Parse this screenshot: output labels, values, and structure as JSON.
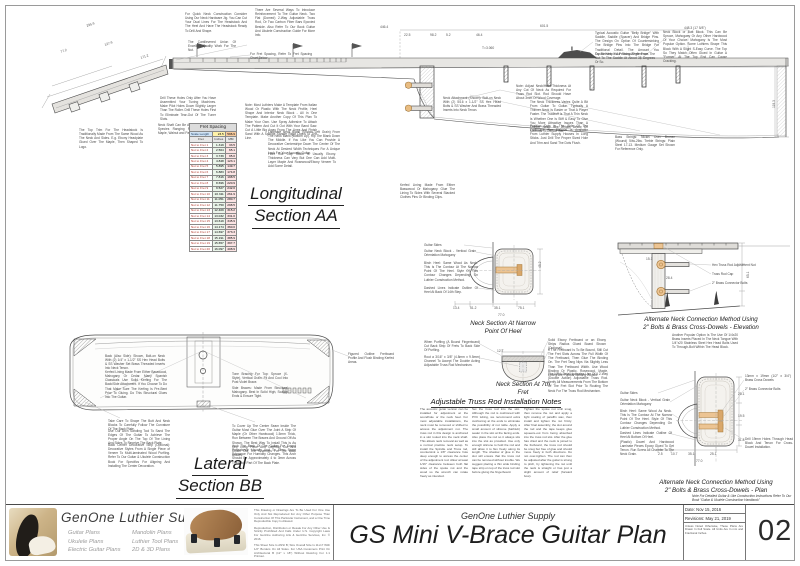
{
  "sheet": {
    "company_small": "GenOne Luthier Supply",
    "title": "GS Mini V-Brace Guitar Plan",
    "number": "02",
    "date": "Date: Nov 15, 2016",
    "revision": "Revisions: May 21, 2019",
    "scale_note": "Unless Noted Otherwise, These Plans Are Drawn In Full Scale. All Units Are In mm and Fractional Inches."
  },
  "logo": {
    "brand": "GenOne Luthier Supplies",
    "plan_types_col1": [
      "Guitar Plans",
      "Ukulele Plans",
      "Electric Guitar Plans"
    ],
    "plan_types_col2": [
      "Mandolin Plans",
      "Luthier Tool Plans",
      "2D & 3D Plans"
    ],
    "legal": [
      "This Drawing or Drawings Are To Be Used For One Use Only And Not Reproduced For Any Other Purpose Than Construction Of This Particular Instrument, and a One Time Reproducible Copy Is Allowed.",
      "Reproduction, Distribution or Resale For Any Other Use Is Strictly Prohibited And Falls Under U.S. Copyright Laws For GenOne Authoring Arts & GenOne Services, Inc. © 2016.",
      "This Sheet Size Is ANSI B; Size Overall Size Is 11x17 With 1/2\" Borders On All Sides. For USA Customers Print On Architectural B (12\" x 18\") Without Resizing For 1:1 Printout."
    ]
  },
  "section_labels": {
    "longitudinal1": "Longitudinal",
    "longitudinal2": "Section AA",
    "lateral1": "Lateral",
    "lateral2": "Section BB",
    "neck_narrow1": "Neck Section At Narrow",
    "neck_narrow2": "Point Of Heel",
    "neck_7th1": "Neck Section At 7th",
    "neck_7th2": "Fret",
    "alt_elev1": "Alternate Neck Connection Method Using",
    "alt_elev2": "2\" Bolts & Brass Cross-Dowels - Elevation",
    "alt_plan1": "Alternate Neck Connection Method Using",
    "alt_plan2": "2\" Bolts & Brass Cross-Dowels - Plan",
    "handbook": "Note For Detailed Guitar & Uke Construction Instructions Refer To Our Book \"Guitar & Ukulele Construction Handbook\""
  },
  "truss_notes": {
    "title": "Adjustable Truss Rod Installation Notes",
    "columns": [
      "The acoustic guitar version can be installed for adjustment at the soundhole or the neck heel. For most adjustable installations, the neck must be removed or shifted to access the adjustment nut. The truss rod in this design is anchored in a slot routed into the neck shaft. This allows neck removal as well as a normal practice neck setup. To install the Spindle and Truss rod, countersink a 1/8\" clearance hole deep enough to access the center of the adjustment rod. Allow at least 1/16\" clearance between both flat sides of the spoke nut and the wood so the wrench can rotate freely as intended.",
      "Set the truss rod into the slot. Although the rod is cushioned with PVC tubing, we recommend extra cushioning at the ends to eliminate the possibility of nut rattle. Apply a small amount of silicone (bathtub) sealer in the slot at the facing ends. Also place the rod so it always sits into the slot as provided. Use only enough silicone to hold the rod and still allow it to flex freely along its length. The shadow of glue in the slot will ensure that the truss rod can be removed without trouble. We suggest placing a thin wide binding tape strip on top of the truss rod slot before gluing the fingerboard.",
      "Tighten the spoke nut until snug, then remove the nut and apply a light coating of paraffin wax, then install and tighten the nut firmly. After final assembly, the slot around the rod and the tape keeps glue squeeze-out from being absorbed into the truss rod slot. After the glue has dried and the neck is joined to the fretboard, the truss rod should be snug but free of glue and should move freely in both directions. Do not over-tighten. The rod can then be adjusted after the guitar is strung to pitch, by tightening the nut until the neck is straight or has just a slight amount of relief (forward bow)."
    ]
  },
  "fret_table": {
    "title": "Fret Spacing",
    "scale_label": "Scale Length",
    "scale_in": "23.5",
    "scale_mm": "596.9",
    "col_fret": "Fret",
    "col_in": "Inches",
    "col_mm": "MM",
    "rows": [
      [
        "Nut to Fret 1",
        "1.319",
        "33.5"
      ],
      [
        "Nut to Fret 2",
        "2.564",
        "65.1"
      ],
      [
        "Nut to Fret 3",
        "3.739",
        "95.0"
      ],
      [
        "Nut to Fret 4",
        "4.848",
        "123.1"
      ],
      [
        "Nut to Fret 5",
        "5.895",
        "149.7"
      ],
      [
        "Nut to Fret 6",
        "6.883",
        "174.8"
      ],
      [
        "Nut to Fret 7",
        "7.816",
        "198.5"
      ],
      [
        "Nut to Fret 8",
        "8.696",
        "220.9"
      ],
      [
        "Nut to Fret 9",
        "9.527",
        "242.0"
      ],
      [
        "Nut to Fret 10",
        "10.311",
        "261.9"
      ],
      [
        "Nut to Fret 11",
        "11.051",
        "280.7"
      ],
      [
        "Nut to Fret 12",
        "11.750",
        "298.5"
      ],
      [
        "Nut to Fret 13",
        "12.409",
        "315.2"
      ],
      [
        "Nut to Fret 14",
        "13.032",
        "331.0"
      ],
      [
        "Nut to Fret 15",
        "13.619",
        "345.9"
      ],
      [
        "Nut to Fret 16",
        "14.174",
        "360.0"
      ],
      [
        "Nut to Fret 17",
        "14.697",
        "373.3"
      ],
      [
        "Nut to Fret 18",
        "15.191",
        "385.9"
      ],
      [
        "Nut to Fret 19",
        "15.657",
        "397.7"
      ],
      [
        "Nut to Fret 20",
        "16.097",
        "408.9"
      ]
    ]
  },
  "annotations": {
    "notes": [
      {
        "x": 185,
        "y": 12,
        "w": 62,
        "t": "For Quick Neck Construction Consider Using Our Neck Hardware Jig. You Can Cut Your Dual Lines For The Headstock And The Heel And Have The Headstock Ready To Drill And Shape."
      },
      {
        "x": 255,
        "y": 8,
        "w": 60,
        "t": "There Are Several Ways To Introduce Reinforcement To The Guitar Neck. Two Flat (Domed) 2-Way Adjustable Truss Rod, Or Two Carbon Fiber Bars Epoxied Beside. Also Refer To Our Book Guitar And Ukulele Construction Guide For More Info."
      },
      {
        "x": 188,
        "y": 40,
        "w": 48,
        "t": "The Cantilevered Union Of Excellent Quality Work For The Nut."
      },
      {
        "x": 250,
        "y": 52,
        "w": 62,
        "t": "For Fret Spacing, Refer To Fret Spacing Chart Below"
      },
      {
        "x": 516,
        "y": 84,
        "w": 55,
        "t": "Note: Adjust Neck/Heel Thickness At Any Cut Of Neck As Required For Truss Rod Slot. Rod Should Have About 3mm Of Wood Coverage."
      },
      {
        "x": 160,
        "y": 96,
        "w": 56,
        "t": "Drill These Holes Only After You Have Assembled Your Tuning Machines. Make Pilot Holes Down Slightly Larger Than The Roller. Drill These Holes First To Eliminate Tear-Out Of The Tuner Slots."
      },
      {
        "x": 158,
        "y": 123,
        "w": 56,
        "t": "Neck Shaft Can Be A Variety Of Wood Species Ranging From Mahogany, Maple, Walnut and Padauk."
      },
      {
        "x": 79,
        "y": 128,
        "w": 64,
        "t": "The Top Trim For The Headstock Is Traditionally Made From The Same Wood As The Neck And Sides. E.g. Ebony Headplate Glued Over The Maple, Then Shaped To Logo."
      },
      {
        "x": 245,
        "y": 103,
        "w": 72,
        "t": "Note: Most Luthiers Make A Template From Italian Wood Or Plastic With The Neck Profile, Heel Shape And Interior Neck Block - All In One Template. Make Another Copy Of This Plan To Make Your Own. Use Spray Adhesive To Attach The Pattern And Cut It Out With Your Band Saw. Cut A Little Big Away From The Lines And Finish Sand With A Spindle Sander Right Down To The Line."
      },
      {
        "x": 268,
        "y": 130,
        "w": 72,
        "t": "Laminate Neck Blank (Shown Left Grain) From The Neck Blank (Bottom Up). Rip The Blank Down The Middle. If You Like You Can Provide A Decorative Centerstripe Down The Center Of The Neck At Desired Width Techniques For A Unique Look For Your Acoustic Guitar."
      },
      {
        "x": 268,
        "y": 152,
        "w": 68,
        "t": "Fibre Dot Cap Stock Is Usually Ebony. Thickness Can Vary But One Can Add Multi-Layer Maple And Rosewood/Ebony Veneer To Add Some Detail."
      },
      {
        "x": 443,
        "y": 96,
        "w": 58,
        "t": "Neck Attachment (Shown): Bolt-on Neck With (2) 5/16 x 1-1/2\" SS Hex Head Bolts & SS Washer And Brass Threaded Inserts Into Neck Tenon."
      },
      {
        "x": 595,
        "y": 31,
        "w": 64,
        "t": "Typical Acoustic Guitar \"Belly Bridge\" With Saddle, Saddle (Spacer) And Bridge Pins. The Design On Option Of Countersinking The Bridge Pins Into The Bridge For Traditional Detail. The Amount You Countersink Is A Personal Preference."
      },
      {
        "x": 595,
        "y": 52,
        "w": 60,
        "t": "Try To Keep Your String Angle From The Nut To The Saddle At About 35 Degrees Or So."
      },
      {
        "x": 663,
        "y": 30,
        "w": 64,
        "t": "Neck Block or Butt Block. This Can Be Spruce, Mahogany Or Any Other Hardwood Of Your Choice. Mahogany Is The Most Popular Option. Some Luthiers Shape This Block With A Slight S-Easy Curve. The Top So They Match Often Glued In Guitar A \"Former\" At The Top End Can Cause Cracking."
      },
      {
        "x": 530,
        "y": 100,
        "w": 58,
        "t": "The Neck Thickness Varies Quite A Bit From Guitar To Guitar. Typically A Thinner Neck Is Easier or That A Player Faster. The Tradeoff Is That A Thin Neck Is Whether One Is Stiff & Easy To Give You More Attractive Issues Than A Thicker Neck. See Details Below On Methods To Decide Too."
      },
      {
        "x": 530,
        "y": 124,
        "w": 58,
        "t": "Position Dots In The Side Of The Fretboard. The Material Is Available From Luthier Supply Houses In Long Sticks. Just Drill The Proper Sized Hole And Trim and Sand The Dots Flush."
      },
      {
        "x": 400,
        "y": 183,
        "w": 55,
        "t": "Kerfed Lining Made From Either Basswood Or Mahogany. Glue The Lining To Sides With Several Stacked Clothes Pins Or Binding Clips."
      },
      {
        "x": 615,
        "y": 135,
        "w": 60,
        "t": "Bass Strings: Nickel Over Bronze (Wound) 54w-26w. Treble Strings: Plain Steel 17-13. Medium Gauge Set Shown For Reference Only."
      },
      {
        "x": 424,
        "y": 243,
        "w": 40,
        "t": "Guitar Sides"
      },
      {
        "x": 424,
        "y": 249,
        "w": 52,
        "t": "Guitar Neck Block - Vertical Grain Orientation Mahogany"
      },
      {
        "x": 424,
        "y": 261,
        "w": 54,
        "t": "Birch Heel: Same Wood As Neck. This Is The Contour At The Narrow Point Of The Heel. Style Of This Contour Changes Depending On Luthier Construction Method."
      },
      {
        "x": 424,
        "y": 286,
        "w": 54,
        "t": "Dashed Lines Indicate Outline Of Heel At Back Of 14th Step."
      },
      {
        "x": 424,
        "y": 340,
        "w": 56,
        "t": "When Purfling (A Bound Fingerboard) Cut Back Strip Of Frets To Back Side Of Purfling."
      },
      {
        "x": 424,
        "y": 355,
        "w": 56,
        "t": "Rout a 3/16\" x 3/8\" (4.8mm x 9.5mm) Channel To Accept The Double Acting Adjustable Truss Rod Mechanism."
      },
      {
        "x": 548,
        "y": 338,
        "w": 58,
        "t": "Solid Ebony Fretboard or an Ebony Strips Radius Glued Board Shown (Optional)."
      },
      {
        "x": 548,
        "y": 348,
        "w": 60,
        "t": "If The Fretboard Is To Be Bound, Still Cut The Fret Slots Across The Full Width Of The Fretboard, Then Glue The Binding On. The Fret Tang Nips Via Slightly Less Than The Fretboard Width. Use Wood Binding Or Plastic. Rosewood, Maple, Ebony Are Popular Binding Woods."
      },
      {
        "x": 548,
        "y": 372,
        "w": 60,
        "t": "The Neck Detail Indicates Use Of A 2-Way (Double Action) Adjustable Truss Rod. Verify All Measurements From The Bottom Of The Fret Slot Prior To Routing The Neck For The Truss Rod Mechanism."
      },
      {
        "x": 712,
        "y": 263,
        "w": 48,
        "t": "Hex Truss Rod Adjustment Nut"
      },
      {
        "x": 712,
        "y": 272,
        "w": 40,
        "t": "Truss Rod Cap"
      },
      {
        "x": 712,
        "y": 281,
        "w": 44,
        "t": "2\" Brass Connector Bolts"
      },
      {
        "x": 672,
        "y": 333,
        "w": 66,
        "t": "Another Popular Option Is The Use Of 1/4x20 Brass Inserts Placed In The Neck Tongue With 1/4\"x20 Stainless Steel Hex Head Bolts Used To Through-Bolt Within The Head Block."
      },
      {
        "x": 745,
        "y": 374,
        "w": 46,
        "t": "13mm x 19mm (1/2\" x 3/4\") Brass Cross Dowels"
      },
      {
        "x": 745,
        "y": 387,
        "w": 44,
        "t": "2\" Brass Connector Bolts"
      },
      {
        "x": 620,
        "y": 391,
        "w": 38,
        "t": "Guitar Sides"
      },
      {
        "x": 620,
        "y": 398,
        "w": 50,
        "t": "Guitar Neck Block - Vertical Grain Orientation Mahogany"
      },
      {
        "x": 620,
        "y": 409,
        "w": 52,
        "t": "Birch Heel: Same Wood As Neck. This Is The Contour At The Narrow Point Of The Heel. Style Of This Contour Changes Depending On Luthier Construction Method."
      },
      {
        "x": 620,
        "y": 431,
        "w": 52,
        "t": "Dashed Lines Indicate Outline Of Heel At Bottom Of Heel."
      },
      {
        "x": 620,
        "y": 440,
        "w": 54,
        "t": "(Plastic) Dowel And Hardwood Laminate Pieces Epoxy Glued To Get Tenon. Run Screw All Chamfer To The Neck Grain."
      },
      {
        "x": 745,
        "y": 437,
        "w": 48,
        "t": "Drill 19mm Holes Through Head Block And Tenon For Cross-Dowel Installation."
      },
      {
        "x": 105,
        "y": 354,
        "w": 60,
        "t": "Back (Also Side): Shown, Bolt-on Neck With (2) 1/4\" x 1-1/2\" SS Hex Head Bolts & SS Washer Set Brass Threaded Inserts Into Neck Tenon."
      },
      {
        "x": 105,
        "y": 370,
        "w": 62,
        "t": "Kerfed Lining Made From Either Basswood, Mahogany Or Cedar. Many Spanish Classicals Use Solid Kerfing For The Back/Side Attachment. If You Choose To Do That Make Sure The Kerfing Is Pre-Bent Prior To Gluing. Do This Structural Glues Into The Guitar."
      },
      {
        "x": 232,
        "y": 372,
        "w": 56,
        "t": "Tone Bracing For Top: Spruce (X-Style), Vertical Grain. Fit And Cool Into Post Violet Brace."
      },
      {
        "x": 232,
        "y": 386,
        "w": 56,
        "t": "Side Braces: Made From Structural Mahogany. Best In Solid High, Scallop Ends & Ensure Tight."
      },
      {
        "x": 348,
        "y": 352,
        "w": 46,
        "t": "Figured Outline Fretboard Profile And Flush Binding Kerfed Areas."
      },
      {
        "x": 108,
        "y": 419,
        "w": 62,
        "t": "Take Care To Shape The Butt And Neck Blocks To Carefully Follow The Curvature Of The Back Plate."
      },
      {
        "x": 108,
        "y": 429,
        "w": 62,
        "t": "Use Our Arch Sanding Tool To Sand The Edges Of The Guitar To Achieve The Proper Angle On The Top Of The Lining And Sides To Receive The Back Plate."
      },
      {
        "x": 108,
        "y": 443,
        "w": 62,
        "t": "Back Center Decorative Strip (Optional): Decorative Styles From A Single Piece of Veneer To Multi-laminated Wood Purfling. Refer To Our Guitar & Ukulele Construction Book For Specifics For Aligning And Installing The Center Decoration."
      },
      {
        "x": 232,
        "y": 424,
        "w": 64,
        "t": "To Cover Up The Center Seam Inside The Guitar Most Glue Over The Joint A Strip Of Maple (Or Other Hardwood) 1.5mm Thick, Run Between The Braces And Ground Off As Shown. The Best Way To Install This Is As One Long Piece And Carefully Cut And Chisel Out The Channels For The Back Braces."
      },
      {
        "x": 232,
        "y": 444,
        "w": 64,
        "t": "Arch The Back Of The Guitar For Sound Reflectance Usually And To Allow Some Tolerance For Humidity Changes. This Arch Should Be Approximately 4 to 3mm Across The Wide Part Of The Back Plate."
      }
    ],
    "dims": [
      {
        "x": 86,
        "y": 24,
        "t": "295.9",
        "r": -18
      },
      {
        "x": 60,
        "y": 50,
        "t": "77.2",
        "r": -18
      },
      {
        "x": 104,
        "y": 43,
        "t": "127.9",
        "r": -18
      },
      {
        "x": 140,
        "y": 56,
        "t": "171.2",
        "r": -18
      },
      {
        "x": 380,
        "y": 25,
        "t": "446.4"
      },
      {
        "x": 540,
        "y": 24,
        "t": "601.5"
      },
      {
        "x": 684,
        "y": 26,
        "t": "448.3 (17 5/8\")"
      },
      {
        "x": 404,
        "y": 33,
        "t": "22.5"
      },
      {
        "x": 430,
        "y": 33,
        "t": "98.2"
      },
      {
        "x": 446,
        "y": 33,
        "t": "5.2"
      },
      {
        "x": 476,
        "y": 33,
        "t": "46.4"
      },
      {
        "x": 482,
        "y": 46,
        "t": "T=3.060"
      },
      {
        "x": 772,
        "y": 108,
        "t": "119.3",
        "r": -90
      },
      {
        "x": 453,
        "y": 306,
        "t": "13.4"
      },
      {
        "x": 470,
        "y": 306,
        "t": "51.2"
      },
      {
        "x": 494,
        "y": 306,
        "t": "35.1"
      },
      {
        "x": 518,
        "y": 306,
        "t": "75.1"
      },
      {
        "x": 498,
        "y": 313,
        "t": "77.0"
      },
      {
        "x": 538,
        "y": 268,
        "t": "45.2",
        "r": -90
      },
      {
        "x": 497,
        "y": 349,
        "t": "12.7"
      },
      {
        "x": 646,
        "y": 257,
        "t": "15.1"
      },
      {
        "x": 666,
        "y": 276,
        "t": "28.4"
      },
      {
        "x": 746,
        "y": 278,
        "t": "65.1",
        "r": -90
      },
      {
        "x": 658,
        "y": 452,
        "t": "2.5"
      },
      {
        "x": 671,
        "y": 452,
        "t": "10.7"
      },
      {
        "x": 688,
        "y": 452,
        "t": "35.1"
      },
      {
        "x": 710,
        "y": 452,
        "t": "25.1"
      },
      {
        "x": 738,
        "y": 392,
        "t": "25.1"
      },
      {
        "x": 738,
        "y": 414,
        "t": "19.5"
      },
      {
        "x": 738,
        "y": 438,
        "t": "31.8"
      },
      {
        "x": 696,
        "y": 459,
        "t": "77.0"
      }
    ]
  }
}
